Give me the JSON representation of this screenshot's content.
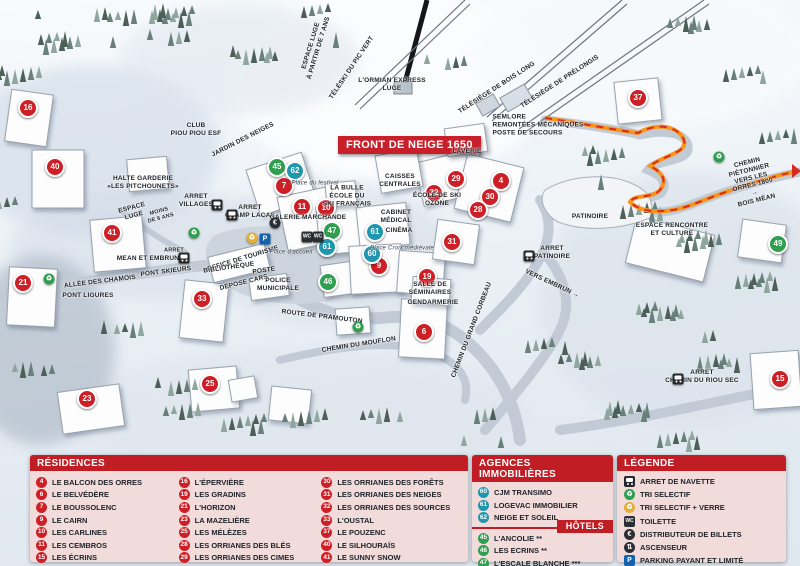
{
  "map": {
    "banner": "FRONT DE NEIGE 1650",
    "colors": {
      "residence_marker": "#ce1f26",
      "hotel_marker": "#2f9e4e",
      "agency_marker": "#1f96ad",
      "header_red": "#c01d25",
      "panel_pink": "#f2dbdb",
      "path_orange": "#f7941d",
      "path_dash_red": "#d62c1e"
    },
    "markers": [
      {
        "num": "16",
        "type": "res",
        "x": 28,
        "y": 108
      },
      {
        "num": "40",
        "type": "res",
        "x": 55,
        "y": 167
      },
      {
        "num": "41",
        "type": "res",
        "x": 112,
        "y": 233
      },
      {
        "num": "21",
        "type": "res",
        "x": 23,
        "y": 283
      },
      {
        "num": "33",
        "type": "res",
        "x": 202,
        "y": 299
      },
      {
        "num": "23",
        "type": "res",
        "x": 87,
        "y": 399
      },
      {
        "num": "25",
        "type": "res",
        "x": 210,
        "y": 384
      },
      {
        "num": "7",
        "type": "res",
        "x": 284,
        "y": 186
      },
      {
        "num": "11",
        "type": "res",
        "x": 302,
        "y": 207
      },
      {
        "num": "10",
        "type": "res",
        "x": 326,
        "y": 208
      },
      {
        "num": "29",
        "type": "res",
        "x": 456,
        "y": 179
      },
      {
        "num": "32",
        "type": "res",
        "x": 434,
        "y": 193
      },
      {
        "num": "4",
        "type": "res",
        "x": 501,
        "y": 181
      },
      {
        "num": "30",
        "type": "res",
        "x": 490,
        "y": 197
      },
      {
        "num": "28",
        "type": "res",
        "x": 478,
        "y": 210
      },
      {
        "num": "31",
        "type": "res",
        "x": 452,
        "y": 242
      },
      {
        "num": "9",
        "type": "res",
        "x": 379,
        "y": 266
      },
      {
        "num": "19",
        "type": "res",
        "x": 427,
        "y": 277
      },
      {
        "num": "6",
        "type": "res",
        "x": 424,
        "y": 332
      },
      {
        "num": "37",
        "type": "res",
        "x": 638,
        "y": 98
      },
      {
        "num": "15",
        "type": "res",
        "x": 780,
        "y": 379
      },
      {
        "num": "45",
        "type": "hot",
        "x": 277,
        "y": 167
      },
      {
        "num": "47",
        "type": "hot",
        "x": 332,
        "y": 231
      },
      {
        "num": "46",
        "type": "hot",
        "x": 328,
        "y": 282
      },
      {
        "num": "49",
        "type": "hot",
        "x": 778,
        "y": 244
      },
      {
        "num": "62",
        "type": "ag",
        "x": 295,
        "y": 171
      },
      {
        "num": "61",
        "type": "ag",
        "x": 375,
        "y": 232
      },
      {
        "num": "61",
        "type": "ag",
        "x": 327,
        "y": 247
      },
      {
        "num": "60",
        "type": "ag",
        "x": 372,
        "y": 254
      }
    ],
    "labels": [
      {
        "t": "ESPACE LUGE\nà partir de 7 ans",
        "x": 315,
        "y": 47,
        "r": -73
      },
      {
        "t": "TÉLÉSKI DU PIC VERT",
        "x": 352,
        "y": 68,
        "r": -56
      },
      {
        "t": "L'ORMIAN EXPRESS\nLUGE",
        "x": 392,
        "y": 85,
        "r": 0
      },
      {
        "t": "TÉLÉSIÈGE DE BOIS LONG",
        "x": 497,
        "y": 88,
        "r": -33
      },
      {
        "t": "TÉLÉSIÈGE DE PRÉLONGIS",
        "x": 560,
        "y": 82,
        "r": -33
      },
      {
        "t": "SEMLORE\nREMONTÉES MÉCANIQUES\nPOSTE DE SECOURS",
        "x": 538,
        "y": 125,
        "r": 0,
        "v": "left"
      },
      {
        "t": "CHEMIN PIÉTONNIER\nVERS LES ORRES 1800 →\nBOIS MÉAN",
        "x": 752,
        "y": 182,
        "r": -14
      },
      {
        "t": "CLUB\nPIOU PIOU ESF",
        "x": 196,
        "y": 130,
        "r": 0
      },
      {
        "t": "JARDIN DES NEIGES",
        "x": 243,
        "y": 140,
        "r": -27
      },
      {
        "t": "HALTE GARDERIE\n«LES PITCHOUNETS»",
        "x": 143,
        "y": 183,
        "r": 0
      },
      {
        "t": "ESPACE\nLUGE",
        "x": 133,
        "y": 212,
        "r": -15
      },
      {
        "t": "MOINS\nDE 6 ANS",
        "x": 160,
        "y": 215,
        "r": -15,
        "v": "tiny"
      },
      {
        "t": "ARRET\nVILLAGES",
        "x": 196,
        "y": 201,
        "r": 0
      },
      {
        "t": "ARRET\nCHAMP LACAS",
        "x": 250,
        "y": 212,
        "r": 0
      },
      {
        "t": "Place du festival",
        "x": 315,
        "y": 184,
        "r": 0,
        "v": "place"
      },
      {
        "t": "LA BULLE\nÉCOLE DU\nSKI FRANÇAIS",
        "x": 347,
        "y": 196,
        "r": 0
      },
      {
        "t": "GALERIE MARCHANDE",
        "x": 308,
        "y": 218,
        "r": 0
      },
      {
        "t": "CAISSES\nCENTRALES",
        "x": 400,
        "y": 181,
        "r": 0
      },
      {
        "t": "LAVERIE",
        "x": 467,
        "y": 152,
        "r": 0
      },
      {
        "t": "ÉCOLE DE SKI\nOZONE",
        "x": 437,
        "y": 200,
        "r": 0
      },
      {
        "t": "CABINET\nMÉDICAL",
        "x": 396,
        "y": 217,
        "r": 0
      },
      {
        "t": "CINÉMA",
        "x": 399,
        "y": 231,
        "r": 0
      },
      {
        "t": "Place Croix médiévale",
        "x": 402,
        "y": 249,
        "r": 0,
        "v": "place"
      },
      {
        "t": "OFFICE DE TOURISME",
        "x": 243,
        "y": 259,
        "r": -17
      },
      {
        "t": "BIBLIOTHÈQUE",
        "x": 229,
        "y": 268,
        "r": -8
      },
      {
        "t": "POSTE",
        "x": 264,
        "y": 271,
        "r": -8
      },
      {
        "t": "Place d'accueil",
        "x": 291,
        "y": 253,
        "r": 0,
        "v": "place"
      },
      {
        "t": "DÉPOSE CARS",
        "x": 244,
        "y": 283,
        "r": -14
      },
      {
        "t": "POLICE\nMUNICIPALE",
        "x": 278,
        "y": 285,
        "r": 0
      },
      {
        "t": "ARRET",
        "x": 174,
        "y": 251,
        "r": 0,
        "v": "tiny"
      },
      {
        "t": "MEAN ET EMBRUN",
        "x": 148,
        "y": 259,
        "r": 0
      },
      {
        "t": "PONT SKIEURS",
        "x": 166,
        "y": 272,
        "r": -7
      },
      {
        "t": "ALLÉE DES CHAMOIS",
        "x": 100,
        "y": 282,
        "r": -7
      },
      {
        "t": "PONT LIGURES",
        "x": 88,
        "y": 296,
        "r": 0
      },
      {
        "t": "ROUTE DE PRAMOUTON",
        "x": 322,
        "y": 317,
        "r": 7
      },
      {
        "t": "CHEMIN DU MOUFLON",
        "x": 359,
        "y": 345,
        "r": -9
      },
      {
        "t": "CHEMIN DU GRAND CORBEAU",
        "x": 472,
        "y": 330,
        "r": -69
      },
      {
        "t": "SALLE DE\nSÉMINAIRES",
        "x": 430,
        "y": 289,
        "r": 0
      },
      {
        "t": "GENDARMERIE",
        "x": 433,
        "y": 303,
        "r": 0
      },
      {
        "t": "PATINOIRE",
        "x": 590,
        "y": 217,
        "r": 0
      },
      {
        "t": "ARRET\nPATINOIRE",
        "x": 552,
        "y": 253,
        "r": 0
      },
      {
        "t": "VERS EMBRUN →",
        "x": 552,
        "y": 284,
        "r": 25
      },
      {
        "t": "ESPACE RENCONTRE\nET CULTURE",
        "x": 672,
        "y": 230,
        "r": 0
      },
      {
        "t": "ARRET\nCHEMIN DU RIOU SEC",
        "x": 702,
        "y": 377,
        "r": 0
      }
    ],
    "poi": [
      {
        "type": "bus",
        "x": 217,
        "y": 205
      },
      {
        "type": "bus",
        "x": 232,
        "y": 215
      },
      {
        "type": "bus",
        "x": 184,
        "y": 258
      },
      {
        "type": "bus",
        "x": 529,
        "y": 256
      },
      {
        "type": "bus",
        "x": 678,
        "y": 379
      },
      {
        "type": "recycle-green",
        "x": 194,
        "y": 233
      },
      {
        "type": "recycle-green",
        "x": 49,
        "y": 279
      },
      {
        "type": "recycle-green",
        "x": 358,
        "y": 327
      },
      {
        "type": "recycle-green",
        "x": 719,
        "y": 157
      },
      {
        "type": "recycle-yellow",
        "x": 252,
        "y": 238
      },
      {
        "type": "parking",
        "x": 265,
        "y": 239
      },
      {
        "type": "euro",
        "x": 275,
        "y": 223
      },
      {
        "type": "toilet",
        "x": 307,
        "y": 237
      },
      {
        "type": "toilet",
        "x": 318,
        "y": 237
      }
    ]
  },
  "panels": {
    "residences": {
      "title": "RÉSIDENCES",
      "items": [
        {
          "num": "4",
          "name": "LE BALCON DES ORRES"
        },
        {
          "num": "6",
          "name": "LE BELVÉDÈRE"
        },
        {
          "num": "7",
          "name": "LE BOUSSOLENC"
        },
        {
          "num": "9",
          "name": "LE CAIRN"
        },
        {
          "num": "10",
          "name": "LES CARLINES"
        },
        {
          "num": "11",
          "name": "LES CEMBROS"
        },
        {
          "num": "15",
          "name": "LES ÉCRINS"
        },
        {
          "num": "16",
          "name": "L'ÉPERVIÈRE"
        },
        {
          "num": "19",
          "name": "LES GRADINS"
        },
        {
          "num": "21",
          "name": "L'HORIZON"
        },
        {
          "num": "23",
          "name": "LA MAZELIÈRE"
        },
        {
          "num": "25",
          "name": "LES MÉLÈZES"
        },
        {
          "num": "28",
          "name": "LES ORRIANES DES BLÉS"
        },
        {
          "num": "29",
          "name": "LES ORRIANES DES CIMES"
        },
        {
          "num": "30",
          "name": "LES ORRIANES DES FORÊTS"
        },
        {
          "num": "31",
          "name": "LES ORRIANES DES NEIGES"
        },
        {
          "num": "32",
          "name": "LES ORRIANES DES SOURCES"
        },
        {
          "num": "33",
          "name": "L'OUSTAL"
        },
        {
          "num": "37",
          "name": "LE POUZENC"
        },
        {
          "num": "40",
          "name": "LE SILHOURAÏS"
        },
        {
          "num": "41",
          "name": "LE SUNNY SNOW"
        }
      ]
    },
    "agencies": {
      "title": "AGENCES IMMOBILIÈRES",
      "items": [
        {
          "num": "60",
          "name": "CJM TRANSIMO"
        },
        {
          "num": "61",
          "name": "LOGEVAC IMMOBILIER"
        },
        {
          "num": "62",
          "name": "NEIGE ET SOLEIL"
        }
      ]
    },
    "hotels": {
      "title": "HÔTELS",
      "items": [
        {
          "num": "45",
          "name": "L'ANCOLIE **"
        },
        {
          "num": "46",
          "name": "LES ECRINS **"
        },
        {
          "num": "47",
          "name": "L'ESCALE BLANCHE ***"
        },
        {
          "num": "49",
          "name": "LES TRAPPEURS **"
        }
      ]
    },
    "legend": {
      "title": "LÉGENDE",
      "items": [
        {
          "icon": "bus",
          "label": "ARRET DE NAVETTE"
        },
        {
          "icon": "recycle-green",
          "label": "TRI SELECTIF"
        },
        {
          "icon": "recycle-yellow",
          "label": "TRI SELECTIF + VERRE"
        },
        {
          "icon": "toilet",
          "label": "TOILETTE"
        },
        {
          "icon": "euro",
          "label": "DISTRIBUTEUR DE BILLETS"
        },
        {
          "icon": "elevator",
          "label": "ASCENSEUR"
        },
        {
          "icon": "parking",
          "label": "PARKING PAYANT ET LIMITÉ"
        }
      ]
    }
  }
}
